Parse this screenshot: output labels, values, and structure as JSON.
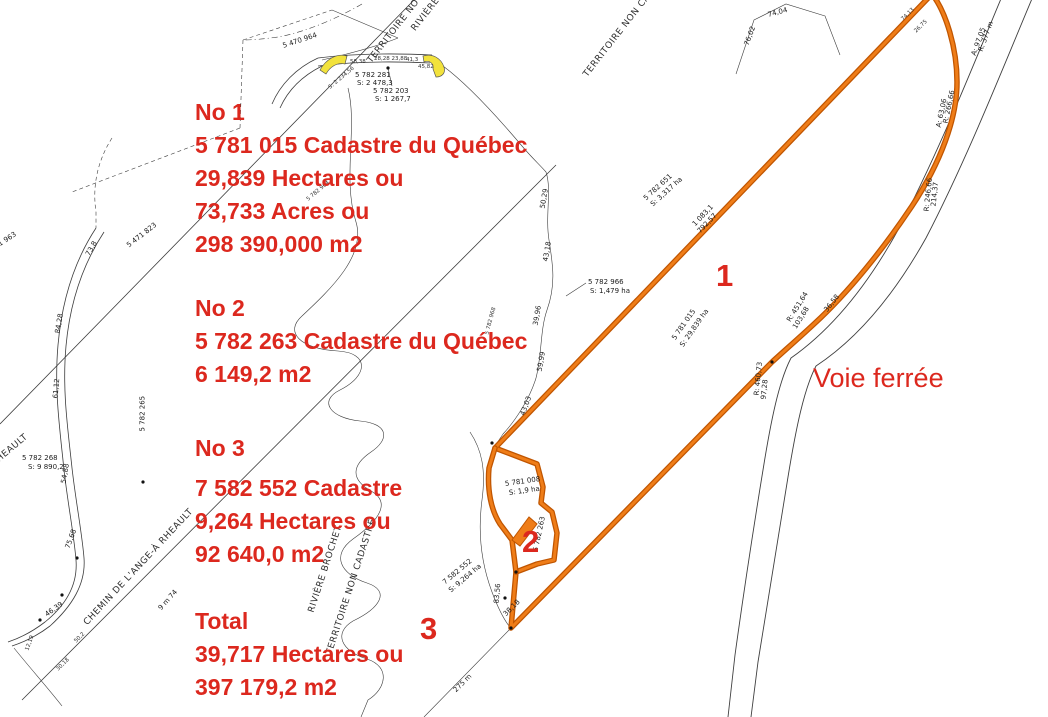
{
  "colors": {
    "red": "#dc281e",
    "orange": "#ef7d18",
    "orange-dark": "#c05500",
    "yellow": "#f2e23c",
    "line": "#3c3c3c"
  },
  "annotations": {
    "blocks": [
      {
        "x": 195,
        "y": 96,
        "lines": [
          "No 1",
          "5 781 015 Cadastre du Québec",
          "29,839 Hectares ou",
          "73,733 Acres ou",
          "298 390,000 m2"
        ]
      },
      {
        "x": 195,
        "y": 292,
        "lines": [
          "No 2",
          "5 782 263 Cadastre du Québec",
          "6 149,2 m2"
        ]
      },
      {
        "x": 195,
        "y": 432,
        "lines": [
          "No 3"
        ]
      },
      {
        "x": 195,
        "y": 472,
        "lines": [
          "7 582 552 Cadastre",
          "9,264 Hectares ou",
          "92 640,0 m2"
        ]
      },
      {
        "x": 195,
        "y": 605,
        "lines": [
          "Total",
          "39,717 Hectares ou",
          "397 179,2 m2"
        ]
      }
    ],
    "parcel_numbers": [
      {
        "t": "1",
        "x": 716,
        "y": 260
      },
      {
        "t": "2",
        "x": 522,
        "y": 526
      },
      {
        "t": "3",
        "x": 420,
        "y": 613
      }
    ],
    "voie_ferree": {
      "t": "Voie ferrée"
    }
  },
  "map_labels": [
    {
      "t": "5 470 964",
      "x": 283,
      "y": 43,
      "r": -18
    },
    {
      "t": "5 471 823",
      "x": 128,
      "y": 243,
      "r": -38
    },
    {
      "t": "5 471 963",
      "x": -14,
      "y": 250,
      "r": -33
    },
    {
      "t": "5 782 268",
      "x": 22,
      "y": 455,
      "r": 0
    },
    {
      "t": "S: 9 890,2",
      "x": 28,
      "y": 464,
      "r": 0
    },
    {
      "t": "5 782 265",
      "x": 143,
      "y": 428,
      "r": -90
    },
    {
      "t": "5 782 281",
      "x": 355,
      "y": 72,
      "r": 0
    },
    {
      "t": "S: 2 478,3",
      "x": 357,
      "y": 80,
      "r": 0
    },
    {
      "t": "5 782 203",
      "x": 373,
      "y": 88,
      "r": 0
    },
    {
      "t": "S: 1 267,7",
      "x": 375,
      "y": 96,
      "r": 0
    },
    {
      "t": "58,38",
      "x": 350,
      "y": 60,
      "r": 0,
      "s": "xs"
    },
    {
      "t": "28,28 23,88",
      "x": 374,
      "y": 57,
      "r": 0,
      "s": "xs"
    },
    {
      "t": "41,3",
      "x": 406,
      "y": 58,
      "r": 0,
      "s": "xs"
    },
    {
      "t": "45,82",
      "x": 418,
      "y": 65,
      "r": 0,
      "s": "xs"
    },
    {
      "t": "S: 2 234,56",
      "x": 330,
      "y": 86,
      "r": -40,
      "s": "xs"
    },
    {
      "t": "5 782 966",
      "x": 588,
      "y": 279,
      "r": 0
    },
    {
      "t": "S: 1,479 ha",
      "x": 590,
      "y": 288,
      "r": 0
    },
    {
      "t": "5 782 964",
      "x": 308,
      "y": 198,
      "r": -40,
      "s": "xs"
    },
    {
      "t": "5 782 968",
      "x": 488,
      "y": 332,
      "r": -75,
      "s": "xs"
    },
    {
      "t": "5 782 651",
      "x": 645,
      "y": 196,
      "r": -42
    },
    {
      "t": "S: 3,317 ha",
      "x": 652,
      "y": 202,
      "r": -42
    },
    {
      "t": "5 781 015",
      "x": 674,
      "y": 336,
      "r": -55
    },
    {
      "t": "S: 29,839 ha",
      "x": 682,
      "y": 343,
      "r": -55
    },
    {
      "t": "5 781 008",
      "x": 505,
      "y": 481,
      "r": -8
    },
    {
      "t": "S: 1,9 ha",
      "x": 509,
      "y": 490,
      "r": -8
    },
    {
      "t": "7 582 552",
      "x": 444,
      "y": 580,
      "r": -40
    },
    {
      "t": "S: 9,264 ha",
      "x": 450,
      "y": 588,
      "r": -40
    },
    {
      "t": "5 782 263",
      "x": 536,
      "y": 548,
      "r": -78
    },
    {
      "t": "275 m",
      "x": 455,
      "y": 688,
      "r": -45
    },
    {
      "t": "9 m 74",
      "x": 160,
      "y": 606,
      "r": -48
    },
    {
      "t": "1 083,1",
      "x": 694,
      "y": 222,
      "r": -46
    },
    {
      "t": "792,57",
      "x": 699,
      "y": 229,
      "r": -46
    },
    {
      "t": "R: 377 m",
      "x": 981,
      "y": 48,
      "r": -70
    },
    {
      "t": "A: 97,05",
      "x": 974,
      "y": 52,
      "r": -70
    },
    {
      "t": "R: 266,66",
      "x": 946,
      "y": 120,
      "r": -78
    },
    {
      "t": "A: 63,06",
      "x": 939,
      "y": 124,
      "r": -78
    },
    {
      "t": "214,37",
      "x": 934,
      "y": 203,
      "r": -84
    },
    {
      "t": "R: 246,66",
      "x": 927,
      "y": 208,
      "r": -84
    },
    {
      "t": "74,13",
      "x": 903,
      "y": 18,
      "r": -45,
      "s": "xs"
    },
    {
      "t": "26,75",
      "x": 916,
      "y": 30,
      "r": -45,
      "s": "xs"
    },
    {
      "t": "R: 451,64",
      "x": 789,
      "y": 318,
      "r": -58
    },
    {
      "t": "103,68",
      "x": 795,
      "y": 325,
      "r": -58
    },
    {
      "t": "36,58",
      "x": 826,
      "y": 308,
      "r": -52
    },
    {
      "t": "R: 460,73",
      "x": 757,
      "y": 392,
      "r": -84
    },
    {
      "t": "97,28",
      "x": 764,
      "y": 396,
      "r": -84
    },
    {
      "t": "50,29",
      "x": 543,
      "y": 205,
      "r": -80
    },
    {
      "t": "43,18",
      "x": 546,
      "y": 258,
      "r": -80
    },
    {
      "t": "39,96",
      "x": 536,
      "y": 322,
      "r": -80
    },
    {
      "t": "59,99",
      "x": 540,
      "y": 368,
      "r": -80
    },
    {
      "t": "43,03",
      "x": 523,
      "y": 412,
      "r": -70
    },
    {
      "t": "83,56",
      "x": 497,
      "y": 600,
      "r": -85
    },
    {
      "t": "38,18",
      "x": 505,
      "y": 612,
      "r": -45
    },
    {
      "t": "73,8",
      "x": 88,
      "y": 252,
      "r": -60
    },
    {
      "t": "84,28",
      "x": 58,
      "y": 330,
      "r": -80
    },
    {
      "t": "61,12",
      "x": 56,
      "y": 395,
      "r": -85
    },
    {
      "t": "54,88",
      "x": 64,
      "y": 480,
      "r": -80
    },
    {
      "t": "75,68",
      "x": 68,
      "y": 545,
      "r": -70
    },
    {
      "t": "46,39",
      "x": 46,
      "y": 612,
      "r": -35
    },
    {
      "t": "12,19",
      "x": 28,
      "y": 648,
      "r": -70,
      "s": "xs"
    },
    {
      "t": "30,18",
      "x": 58,
      "y": 668,
      "r": -45,
      "s": "xs"
    },
    {
      "t": "50,2",
      "x": 76,
      "y": 640,
      "r": -45,
      "s": "xs"
    },
    {
      "t": "76,02",
      "x": 747,
      "y": 42,
      "r": -70
    },
    {
      "t": "74,04",
      "x": 768,
      "y": 12,
      "r": -15
    },
    {
      "t": "TERRITOIRE NO",
      "x": 370,
      "y": 58,
      "r": -52,
      "s": "md"
    },
    {
      "t": "RIVIÈRE",
      "x": 414,
      "y": 26,
      "r": -52,
      "s": "md"
    },
    {
      "t": "TERRITOIRE NON CADASTRÉ",
      "x": 586,
      "y": 72,
      "r": -52,
      "s": "md"
    },
    {
      "t": "RIVIÈRE BROCHET",
      "x": 312,
      "y": 608,
      "r": -72,
      "s": "md"
    },
    {
      "t": "TERRITOIRE NON CADASTRÉ",
      "x": 330,
      "y": 650,
      "r": -72,
      "s": "md"
    },
    {
      "t": "CHEMIN DE L'ANGE-À RHEAULT",
      "x": 86,
      "y": 620,
      "r": -47,
      "s": "md"
    },
    {
      "t": "CHEMIN DE L'ANGE-À RHEAULT",
      "x": -92,
      "y": 532,
      "r": -40,
      "s": "md"
    }
  ]
}
